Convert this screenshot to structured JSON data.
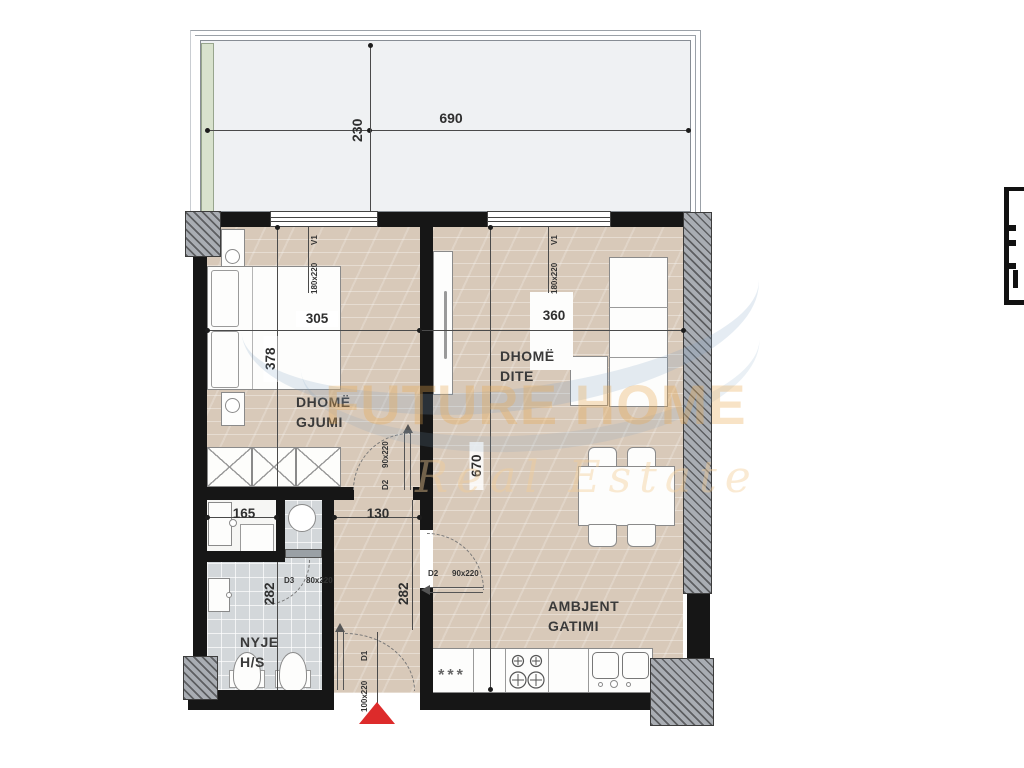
{
  "watermark": {
    "title": "FUTURE HOME",
    "subtitle": "Real Estate"
  },
  "rooms": {
    "bedroom": {
      "line1": "DHOMË",
      "line2": "GJUMI"
    },
    "living": {
      "line1": "DHOMË",
      "line2": "DITE"
    },
    "kitchen": {
      "line1": "AMBJENT",
      "line2": "GATIMI"
    },
    "bath": {
      "line1": "NYJE",
      "line2": "H/S"
    }
  },
  "dimensions": {
    "balcony_width": "690",
    "balcony_depth": "230",
    "bedroom_width": "305",
    "bedroom_length": "378",
    "living_width": "360",
    "living_length": "670",
    "bath_width": "165",
    "hall_width": "130",
    "bath_length": "282",
    "hall_length": "282"
  },
  "windows": {
    "bedroom": {
      "code": "V1",
      "size": "180x220"
    },
    "living": {
      "code": "V1",
      "size": "180x220"
    }
  },
  "doors": {
    "bedroom": {
      "code": "D2",
      "size": "90x220"
    },
    "kitchen": {
      "code": "D2",
      "size": "90x220"
    },
    "bath": {
      "code": "D3",
      "size": "80x220"
    },
    "entrance": {
      "code": "D1",
      "size": "100x220"
    }
  },
  "symbols": {
    "freezer_stars": "***"
  },
  "colors": {
    "wall": "#161616",
    "floor_wood": "#d8c9b9",
    "floor_tile": "#d3d7da",
    "balcony_green": "#d8e2cd",
    "entrance_marker_red": "#dd2b2b",
    "watermark_orange": "#e8a84e",
    "watermark_blue": "#7da2c4"
  }
}
